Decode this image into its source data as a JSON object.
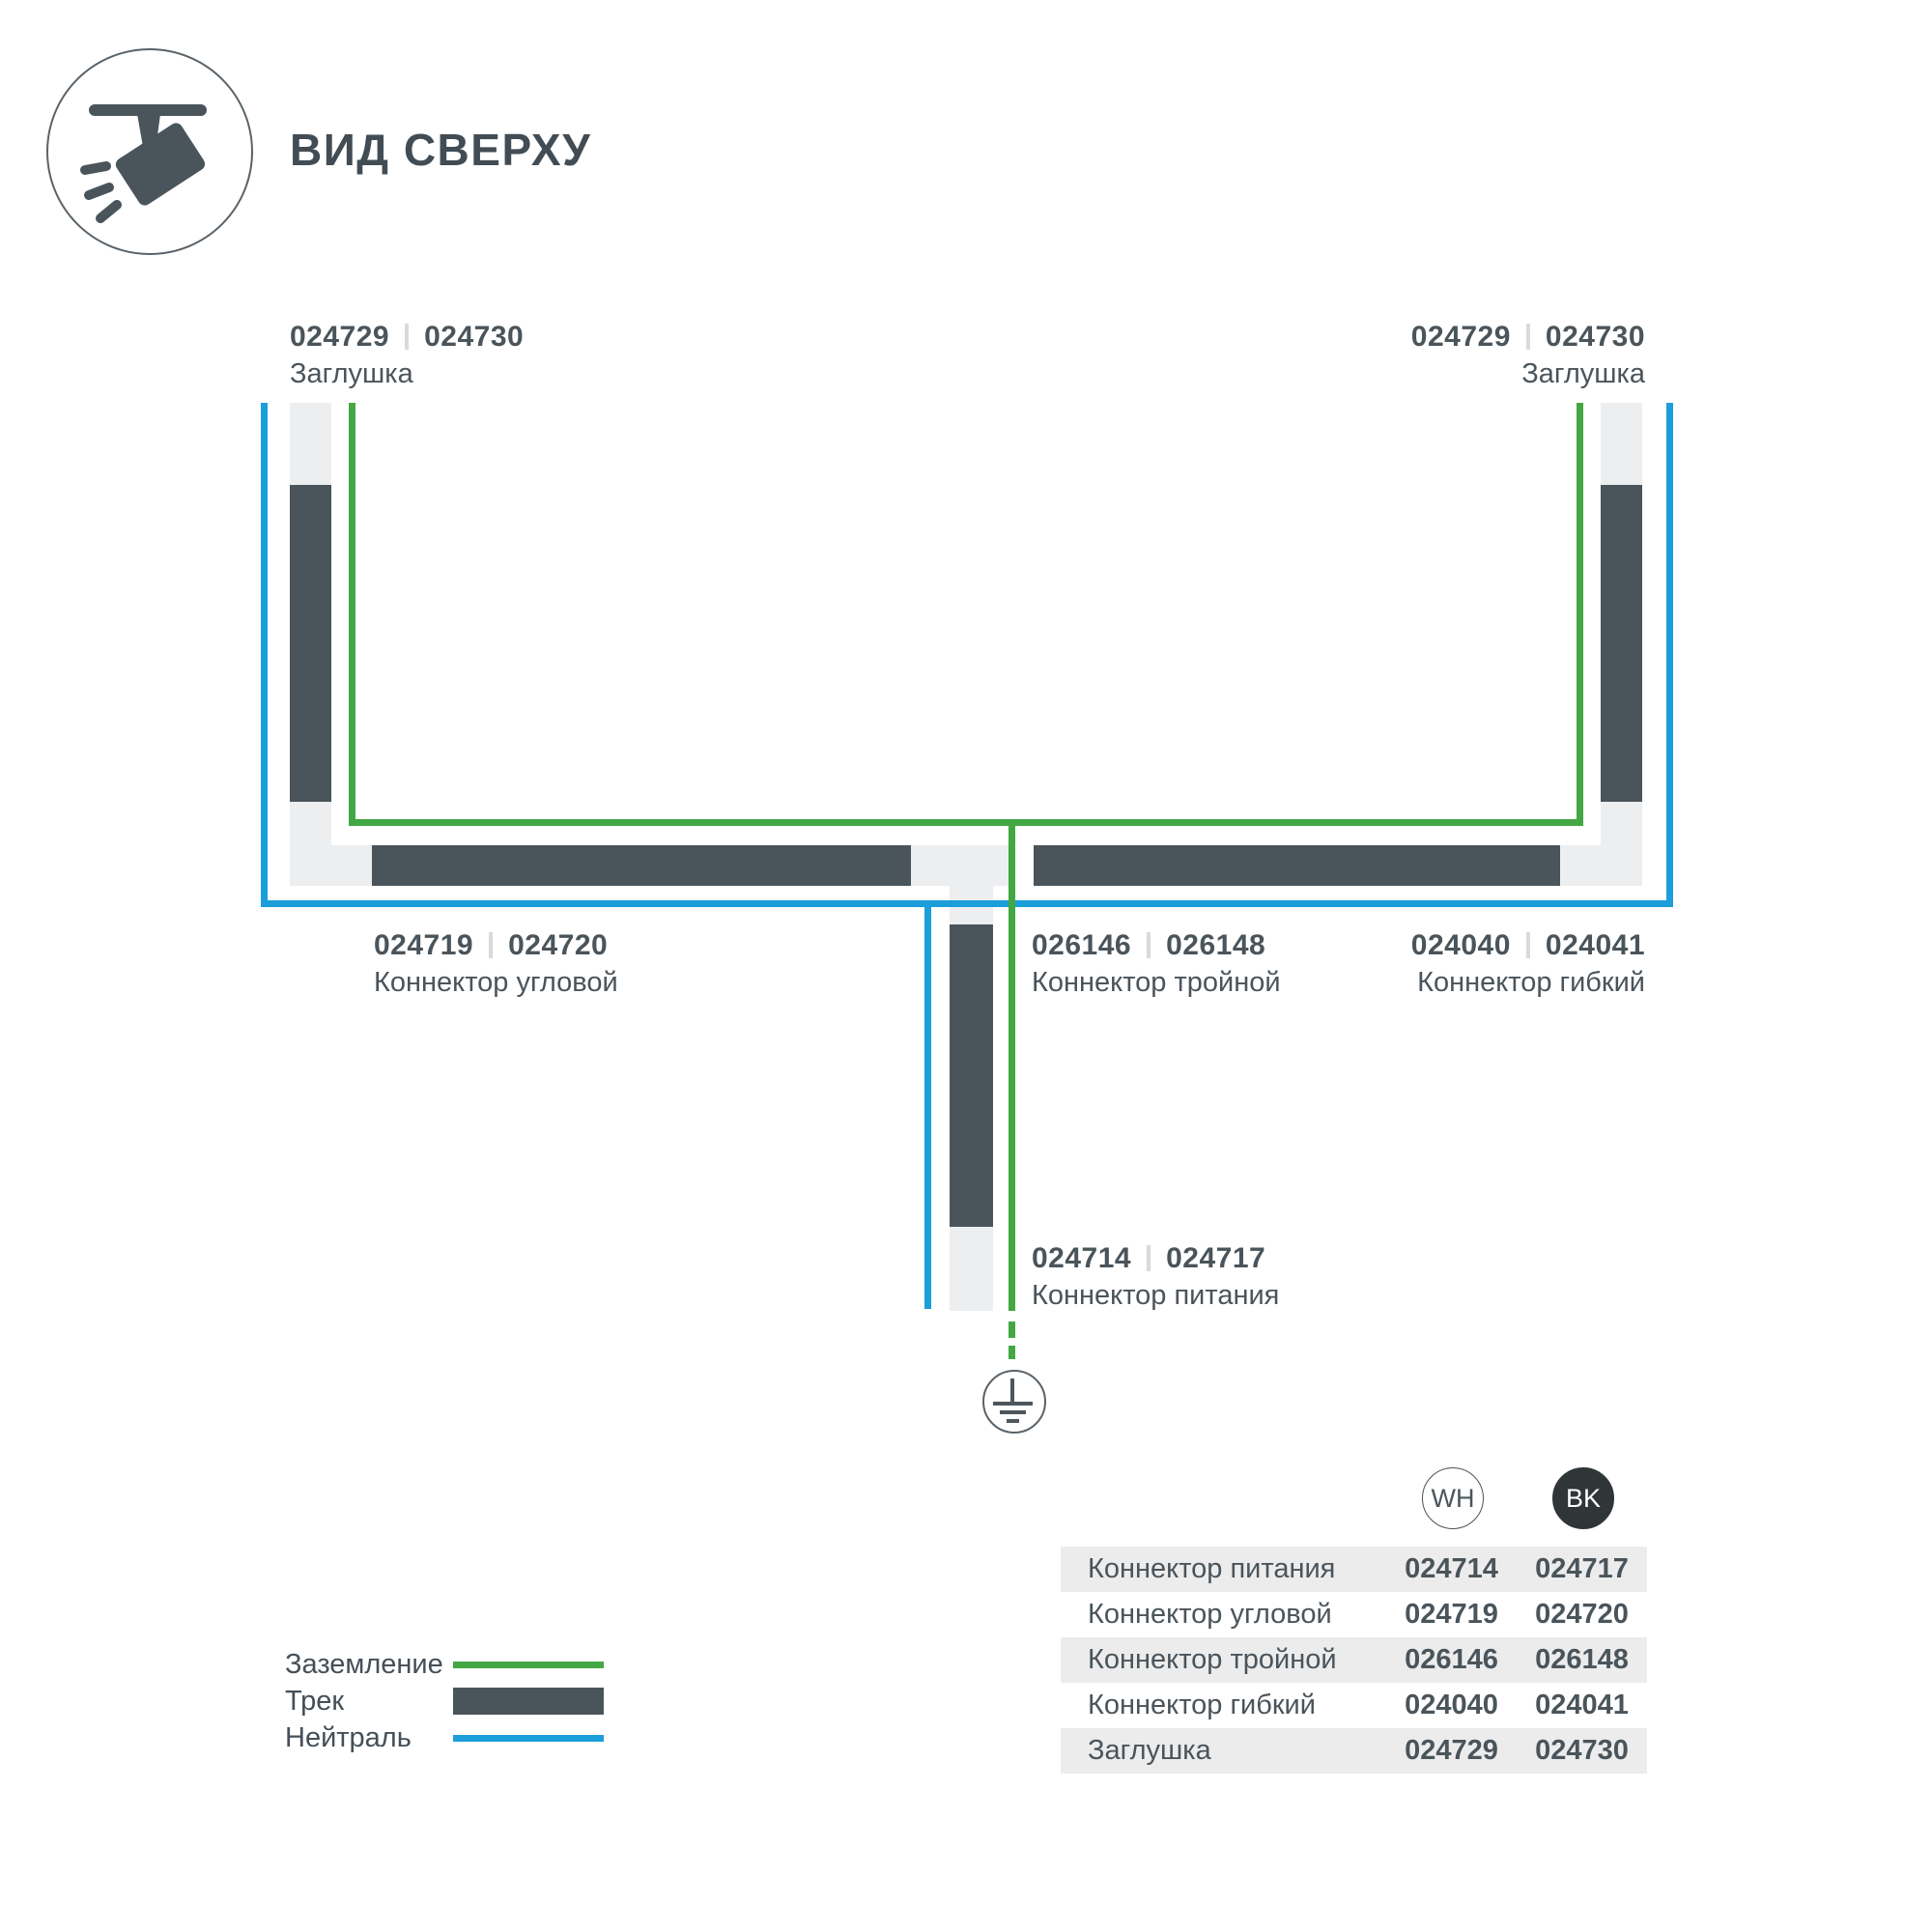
{
  "header": {
    "title": "ВИД СВЕРХУ",
    "icon": "track-spotlight-icon"
  },
  "diagram": {
    "labels": {
      "endcap_left": {
        "codes": [
          "024729",
          "024730"
        ],
        "name": "Заглушка"
      },
      "endcap_right": {
        "codes": [
          "024729",
          "024730"
        ],
        "name": "Заглушка"
      },
      "corner": {
        "codes": [
          "024719",
          "024720"
        ],
        "name": "Коннектор угловой"
      },
      "triple": {
        "codes": [
          "026146",
          "026148"
        ],
        "name": "Коннектор тройной"
      },
      "flex": {
        "codes": [
          "024040",
          "024041"
        ],
        "name": "Коннектор гибкий"
      },
      "power": {
        "codes": [
          "024714",
          "024717"
        ],
        "name": "Коннектор питания"
      }
    },
    "colors": {
      "track_dark": "#4a545b",
      "track_light": "#eceeef",
      "ground_wire": "#43a843",
      "neutral_wire": "#1b9ed9"
    },
    "ground_symbol": "earth-ground"
  },
  "legend": {
    "items": [
      {
        "label": "Заземление",
        "type": "ground"
      },
      {
        "label": "Трек",
        "type": "track"
      },
      {
        "label": "Нейтраль",
        "type": "neutral"
      }
    ]
  },
  "table": {
    "columns": [
      {
        "code": "WH"
      },
      {
        "code": "BK"
      }
    ],
    "rows": [
      {
        "name": "Коннектор питания",
        "wh": "024714",
        "bk": "024717"
      },
      {
        "name": "Коннектор угловой",
        "wh": "024719",
        "bk": "024720"
      },
      {
        "name": "Коннектор тройной",
        "wh": "026146",
        "bk": "026148"
      },
      {
        "name": "Коннектор гибкий",
        "wh": "024040",
        "bk": "024041"
      },
      {
        "name": "Заглушка",
        "wh": "024729",
        "bk": "024730"
      }
    ]
  }
}
